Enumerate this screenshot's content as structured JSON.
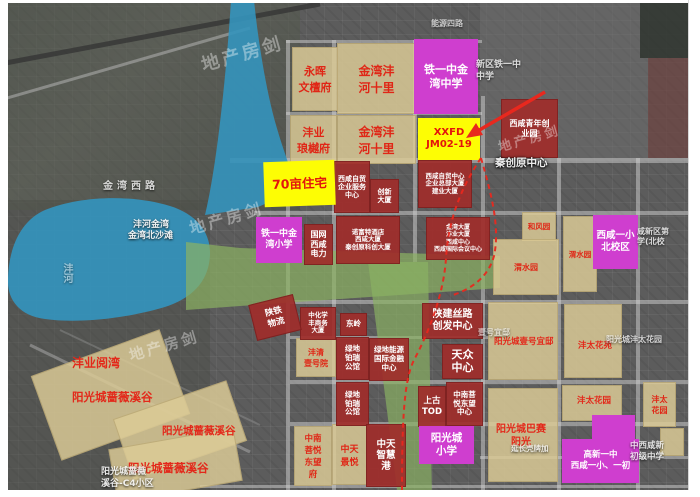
{
  "watermark_text": "地产房剑",
  "colors": {
    "magenta": "#cf3ecf",
    "red_box": "#a02d2a",
    "yellow": "#fdfd04",
    "red_text": "#e3281a",
    "lake": "#3494bd",
    "green": "#8bb263"
  },
  "water": {
    "lake_label_line1": "沣河金湾",
    "lake_label_line2": "金湾北沙滩",
    "river_vertical": "沣河"
  },
  "roads": {
    "jinwan_west_road": "金湾西路",
    "nengyuan_4_road": "能源四路"
  },
  "tan_blocks": [
    {
      "label": "永晖\n文檀府"
    },
    {
      "label": "金湾沣\n河十里"
    },
    {
      "label": "沣业\n琅樾府"
    },
    {
      "label": "金湾沣\n河十里"
    },
    {
      "label": "和风园"
    },
    {
      "label": "渭水园"
    },
    {
      "label": "渭水园"
    },
    {
      "label": "沣清\n壹号院"
    },
    {
      "label": "沣太\n花园"
    },
    {
      "label": "中南\n菩悦\n东望\n府"
    },
    {
      "label": "中天\n景悦"
    }
  ],
  "red_boxes": [
    {
      "label": "西咸青年创\n业园"
    },
    {
      "label": "西咸自贸\n企业服务\n中心"
    },
    {
      "label": "创新\n大厦"
    },
    {
      "label": "西咸自贸中心\n企业总部大厦\n建业大厦"
    },
    {
      "label": "国网\n西咸\n电力"
    },
    {
      "label": "诺富特酒店\n西咸大厦\n秦创原科创大厦"
    },
    {
      "label": "金湾大厦\n沣业大厦\n西咸中心\n西咸国际会议中心"
    },
    {
      "label": "陕建丝路\n创发中心"
    },
    {
      "label": "东岭"
    },
    {
      "label": "中化学\n丰商务\n大厦"
    },
    {
      "label": "绿地\n铂瑞\n公馆"
    },
    {
      "label": "绿地能源\n国际金融\n中心"
    },
    {
      "label": "天众\n中心"
    },
    {
      "label": "绿地\n铂瑞\n公馆"
    },
    {
      "label": "上古\nTOD"
    },
    {
      "label": "中南菩\n悦东望\n中心"
    },
    {
      "label": "中天\n智慧\n港"
    },
    {
      "label": "陕铁\n物流"
    }
  ],
  "magenta_boxes": [
    {
      "label": "铁一中金\n湾中学"
    },
    {
      "label": "铁一中金\n湾小学"
    },
    {
      "label": "西咸一小\n北校区"
    },
    {
      "label": "阳光城\n小学"
    },
    {
      "label": "高新一中\n西咸一小、一初"
    }
  ],
  "yellow_boxes": [
    {
      "label": "70亩住宅"
    },
    {
      "label": "XXFD\nJM02-19"
    }
  ],
  "red_labels": [
    {
      "label": "沣业阅湾"
    },
    {
      "label": "阳光城蔷薇溪谷"
    },
    {
      "label": "阳光城蔷薇溪谷"
    },
    {
      "label": "阳光城蔷薇溪谷"
    },
    {
      "label": "阳光城壹号宜邸"
    },
    {
      "label": "沣太花苑"
    },
    {
      "label": "沣太花园"
    },
    {
      "label": "阳光城巴赛\n阳光"
    }
  ],
  "base_labels": [
    {
      "label": "秦创原中心"
    },
    {
      "label": "新区铁一中\n中学"
    },
    {
      "label": "咸新区第\n学(北校"
    },
    {
      "label": "阳光城沣太花园"
    },
    {
      "label": "壹号宜邸"
    },
    {
      "label": "延长壳牌加"
    },
    {
      "label": "中西咸新\n初级中学"
    },
    {
      "label": "阳光城蔷薇\n溪谷-C4小区"
    }
  ]
}
